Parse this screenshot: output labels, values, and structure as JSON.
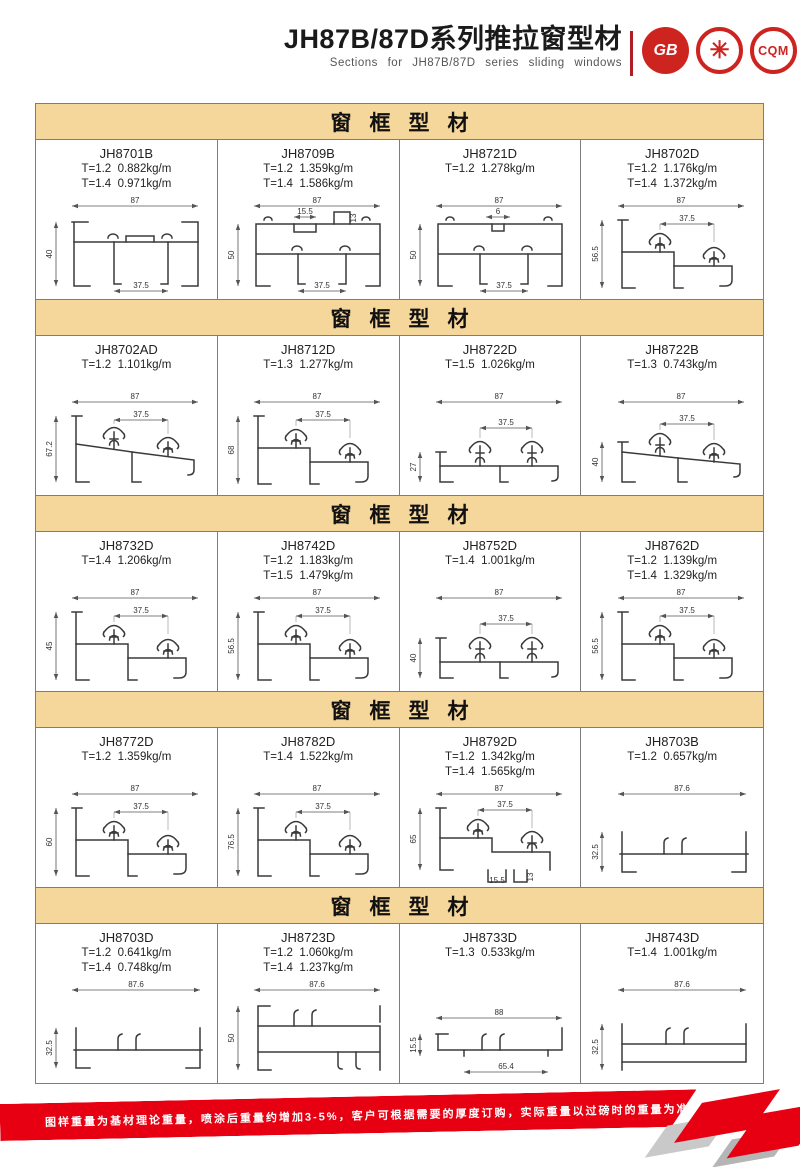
{
  "header": {
    "title": "JH87B/87D系列推拉窗型材",
    "subtitle": "Sections for JH87B/87D series sliding windows",
    "logos": [
      {
        "id": "gb",
        "label": "GB"
      },
      {
        "id": "emblem",
        "label": "✳"
      },
      {
        "id": "cqm",
        "label": "CQM"
      }
    ]
  },
  "sections": [
    {
      "title": "窗框型材",
      "cells": [
        {
          "code": "JH8701B",
          "specs": [
            "T=1.2  0.882kg/m",
            "T=1.4  0.971kg/m"
          ],
          "drawing": {
            "style": "channel",
            "top": "87",
            "left": "40",
            "bottom": "37.5"
          }
        },
        {
          "code": "JH8709B",
          "specs": [
            "T=1.2  1.359kg/m",
            "T=1.4  1.586kg/m"
          ],
          "drawing": {
            "style": "box",
            "top": "87",
            "left": "50",
            "bottom": "37.5",
            "sub": "15.5",
            "sub2": "13"
          }
        },
        {
          "code": "JH8721D",
          "specs": [
            "T=1.2  1.278kg/m"
          ],
          "drawing": {
            "style": "box",
            "top": "87",
            "left": "50",
            "bottom": "37.5",
            "sub": "6"
          }
        },
        {
          "code": "JH8702D",
          "specs": [
            "T=1.2  1.176kg/m",
            "T=1.4  1.372kg/m"
          ],
          "drawing": {
            "style": "hooks",
            "top": "87",
            "left": "56.5",
            "inner": "37.5"
          }
        }
      ]
    },
    {
      "title": "窗框型材",
      "cells": [
        {
          "code": "JH8702AD",
          "specs": [
            "T=1.2  1.101kg/m"
          ],
          "drawing": {
            "style": "hooks-slope",
            "top": "87",
            "left": "67.2",
            "inner": "37.5"
          }
        },
        {
          "code": "JH8712D",
          "specs": [
            "T=1.3  1.277kg/m"
          ],
          "drawing": {
            "style": "hooks",
            "top": "87",
            "left": "68",
            "inner": "37.5"
          }
        },
        {
          "code": "JH8722D",
          "specs": [
            "T=1.5  1.026kg/m"
          ],
          "drawing": {
            "style": "hooks-low",
            "top": "87",
            "left": "27",
            "inner": "37.5"
          }
        },
        {
          "code": "JH8722B",
          "specs": [
            "T=1.3  0.743kg/m"
          ],
          "drawing": {
            "style": "hooks-slope-low",
            "top": "87",
            "left": "40",
            "inner": "37.5"
          }
        }
      ]
    },
    {
      "title": "窗框型材",
      "cells": [
        {
          "code": "JH8732D",
          "specs": [
            "T=1.4  1.206kg/m"
          ],
          "drawing": {
            "style": "hooks",
            "top": "87",
            "left": "45",
            "inner": "37.5"
          }
        },
        {
          "code": "JH8742D",
          "specs": [
            "T=1.2  1.183kg/m",
            "T=1.5  1.479kg/m"
          ],
          "drawing": {
            "style": "hooks",
            "top": "87",
            "left": "56.5",
            "inner": "37.5"
          }
        },
        {
          "code": "JH8752D",
          "specs": [
            "T=1.4  1.001kg/m"
          ],
          "drawing": {
            "style": "hooks-low",
            "top": "87",
            "left": "40",
            "inner": "37.5"
          }
        },
        {
          "code": "JH8762D",
          "specs": [
            "T=1.2  1.139kg/m",
            "T=1.4  1.329kg/m"
          ],
          "drawing": {
            "style": "hooks",
            "top": "87",
            "left": "56.5",
            "inner": "37.5"
          }
        }
      ]
    },
    {
      "title": "窗框型材",
      "cells": [
        {
          "code": "JH8772D",
          "specs": [
            "T=1.2  1.359kg/m"
          ],
          "drawing": {
            "style": "hooks",
            "top": "87",
            "left": "60",
            "inner": "37.5"
          }
        },
        {
          "code": "JH8782D",
          "specs": [
            "T=1.4  1.522kg/m"
          ],
          "drawing": {
            "style": "hooks",
            "top": "87",
            "left": "76.5",
            "inner": "37.5"
          }
        },
        {
          "code": "JH8792D",
          "specs": [
            "T=1.2  1.342kg/m",
            "T=1.4  1.565kg/m"
          ],
          "drawing": {
            "style": "hooks-notch",
            "top": "87",
            "left": "65",
            "inner": "37.5",
            "sub": "15.5",
            "sub2": "13"
          }
        },
        {
          "code": "JH8703B",
          "specs": [
            "T=1.2  0.657kg/m"
          ],
          "drawing": {
            "style": "flat",
            "top": "87.6",
            "left": "32.5"
          }
        }
      ]
    },
    {
      "title": "窗框型材",
      "cells": [
        {
          "code": "JH8703D",
          "specs": [
            "T=1.2  0.641kg/m",
            "T=1.4  0.748kg/m"
          ],
          "drawing": {
            "style": "flat",
            "top": "87.6",
            "left": "32.5"
          }
        },
        {
          "code": "JH8723D",
          "specs": [
            "T=1.2  1.060kg/m",
            "T=1.4  1.237kg/m"
          ],
          "drawing": {
            "style": "flat-tall",
            "top": "87.6",
            "left": "50"
          }
        },
        {
          "code": "JH8733D",
          "specs": [
            "T=1.3  0.533kg/m"
          ],
          "drawing": {
            "style": "flat-low",
            "top": "88",
            "left": "15.5",
            "bottom": "65.4"
          }
        },
        {
          "code": "JH8743D",
          "specs": [
            "T=1.4  1.001kg/m"
          ],
          "drawing": {
            "style": "flat-bar",
            "top": "87.6",
            "left": "32.5"
          }
        }
      ]
    }
  ],
  "footer": {
    "disclaimer": "图样重量为基材理论重量，喷涂后重量约增加3-5%，客户可根据需要的厚度订购，实际重量以过磅时的重量为准。",
    "brand_line1": "JIAHUA",
    "brand_line2": "ALUMINIUM",
    "page_number": "35"
  },
  "colors": {
    "accent_red": "#E60012",
    "logo_red": "#CE2420",
    "section_header_tan": "#F5D69B",
    "table_border": "#7d7d7d"
  }
}
